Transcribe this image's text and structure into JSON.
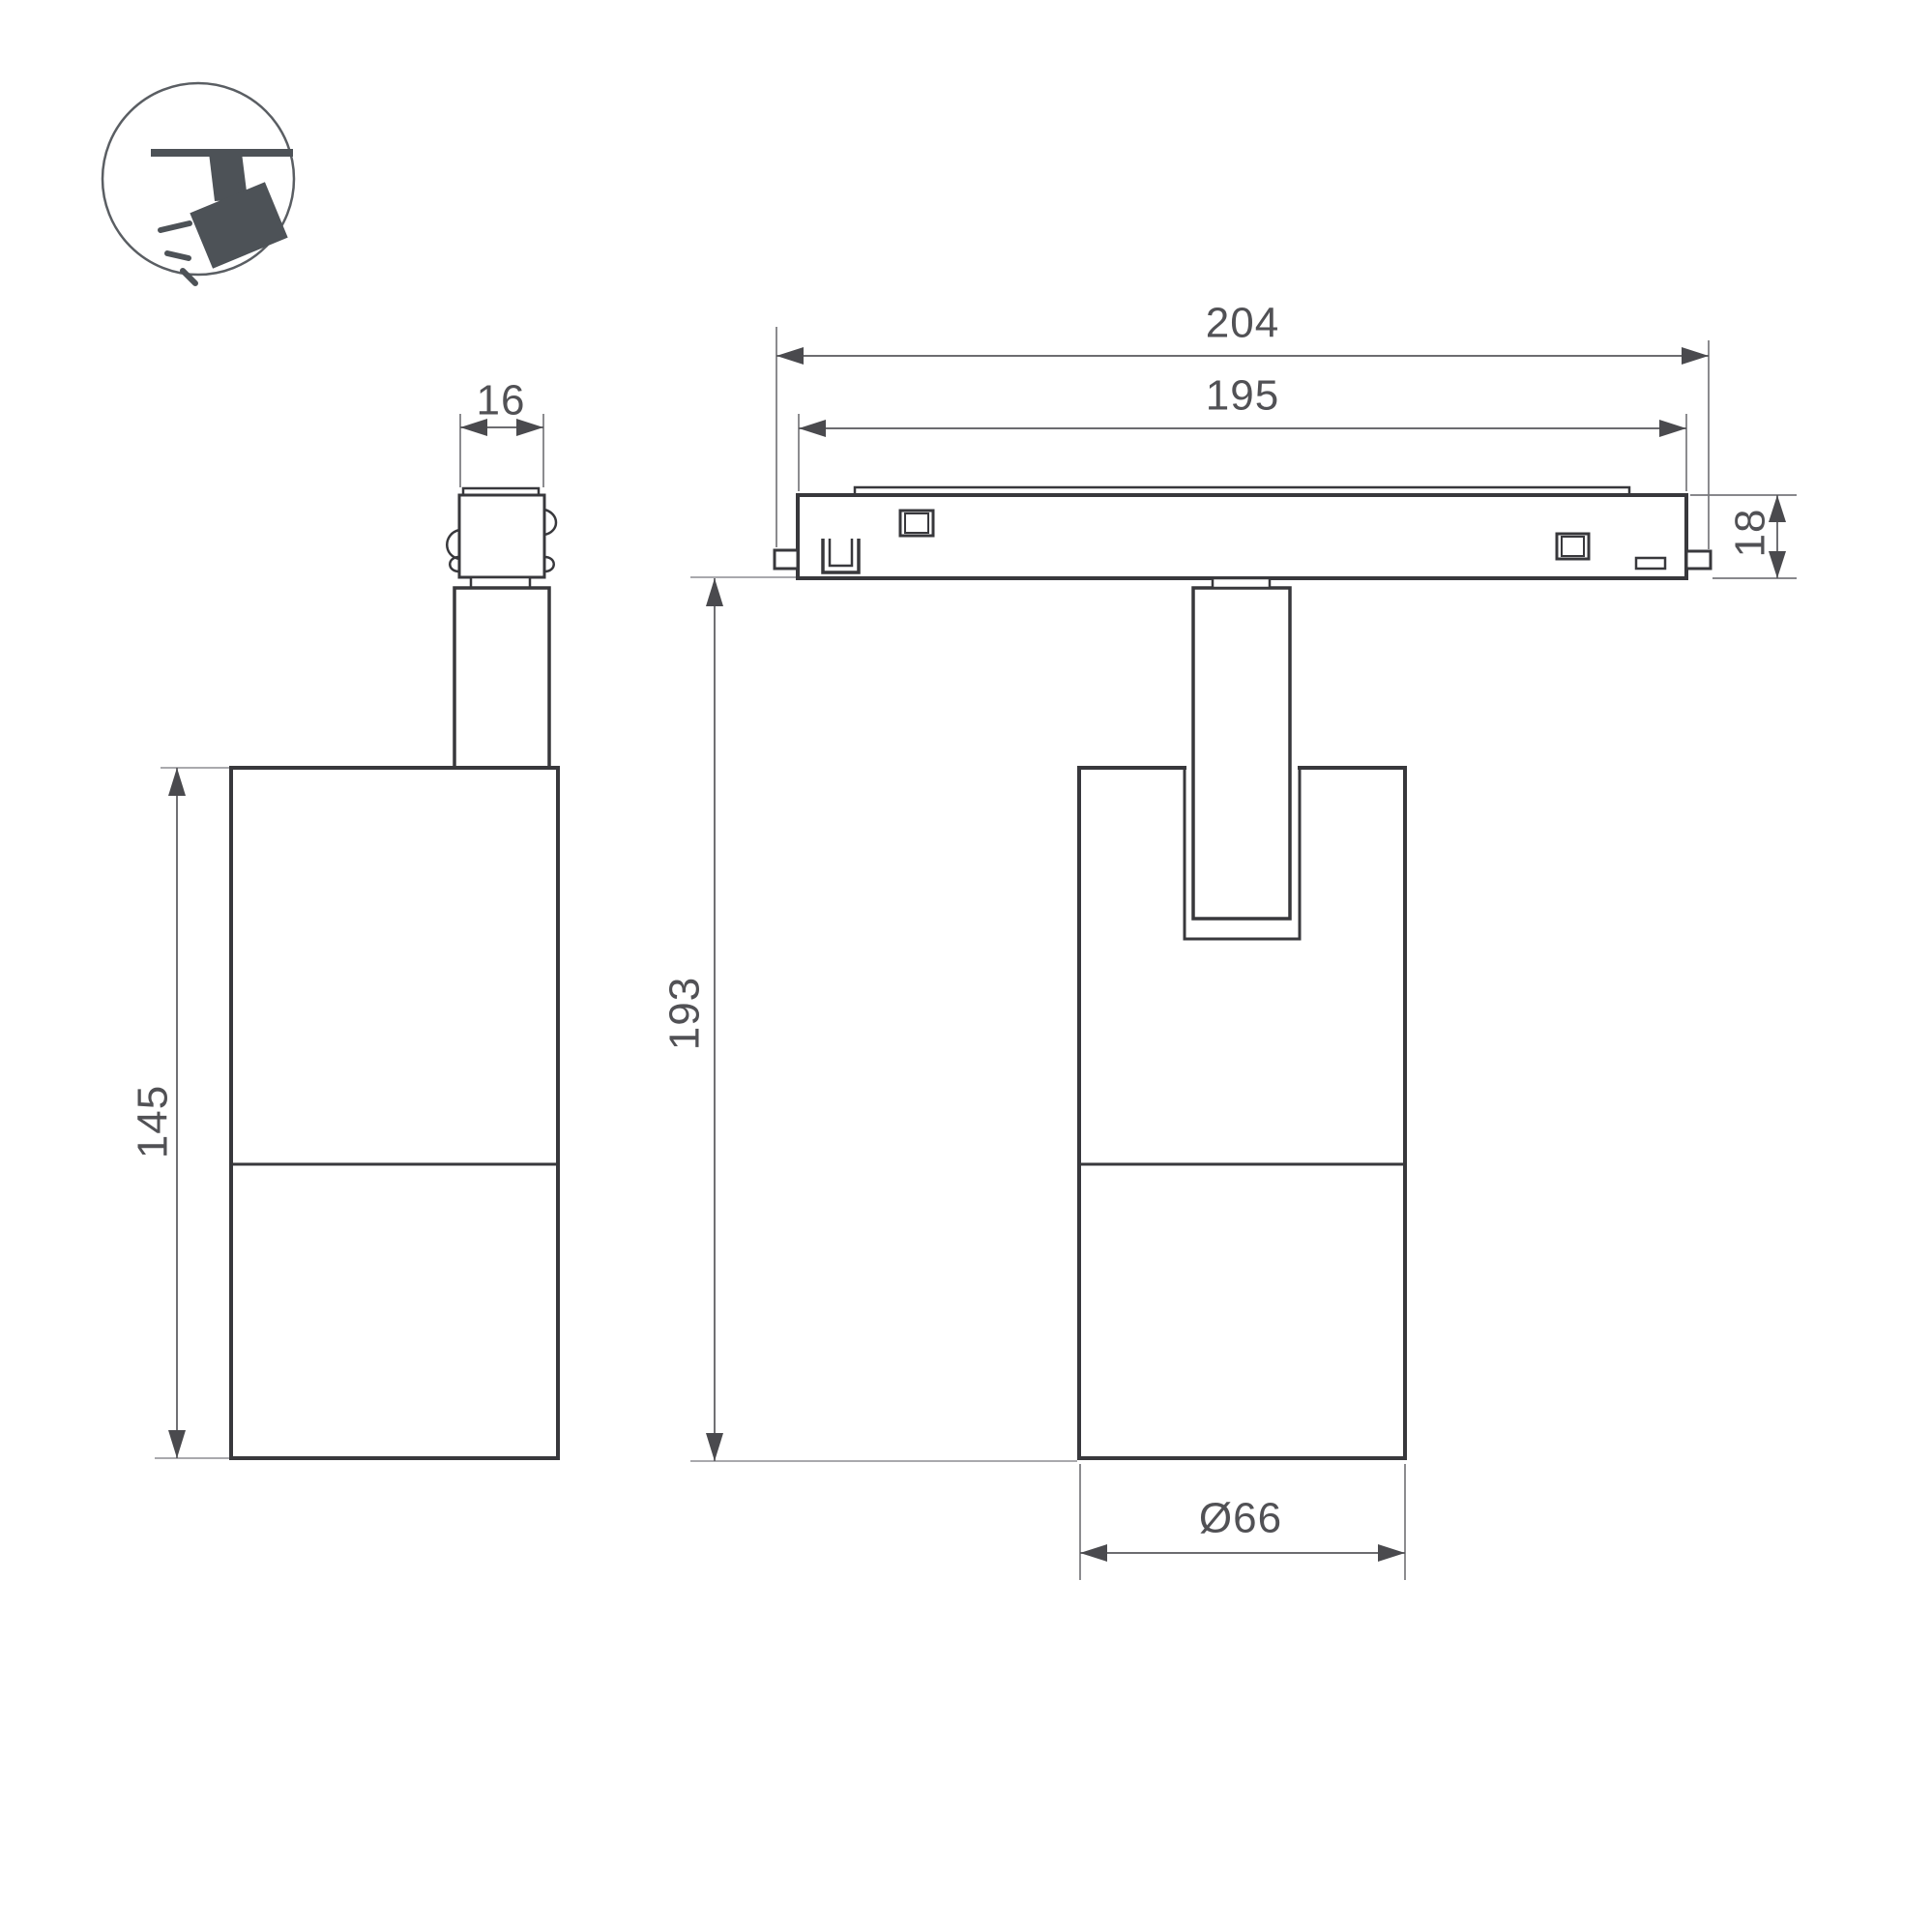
{
  "drawing": {
    "type": "product-dimension-drawing",
    "views": {
      "side_view": "spotlight side view with track adapter",
      "front_view": "spotlight front view hanging from magnetic track"
    },
    "dims": {
      "adapter_width": "16",
      "body_height": "145",
      "track_outer_length": "204",
      "track_inner_length": "195",
      "track_height": "18",
      "fixture_height": "193",
      "body_diameter": "Ø66"
    },
    "colors": {
      "background": "#ffffff",
      "outline": "#38383c",
      "dimension": "#57575b",
      "extension_light": "#a9a9ad",
      "icon_fill": "#4d5257"
    }
  }
}
